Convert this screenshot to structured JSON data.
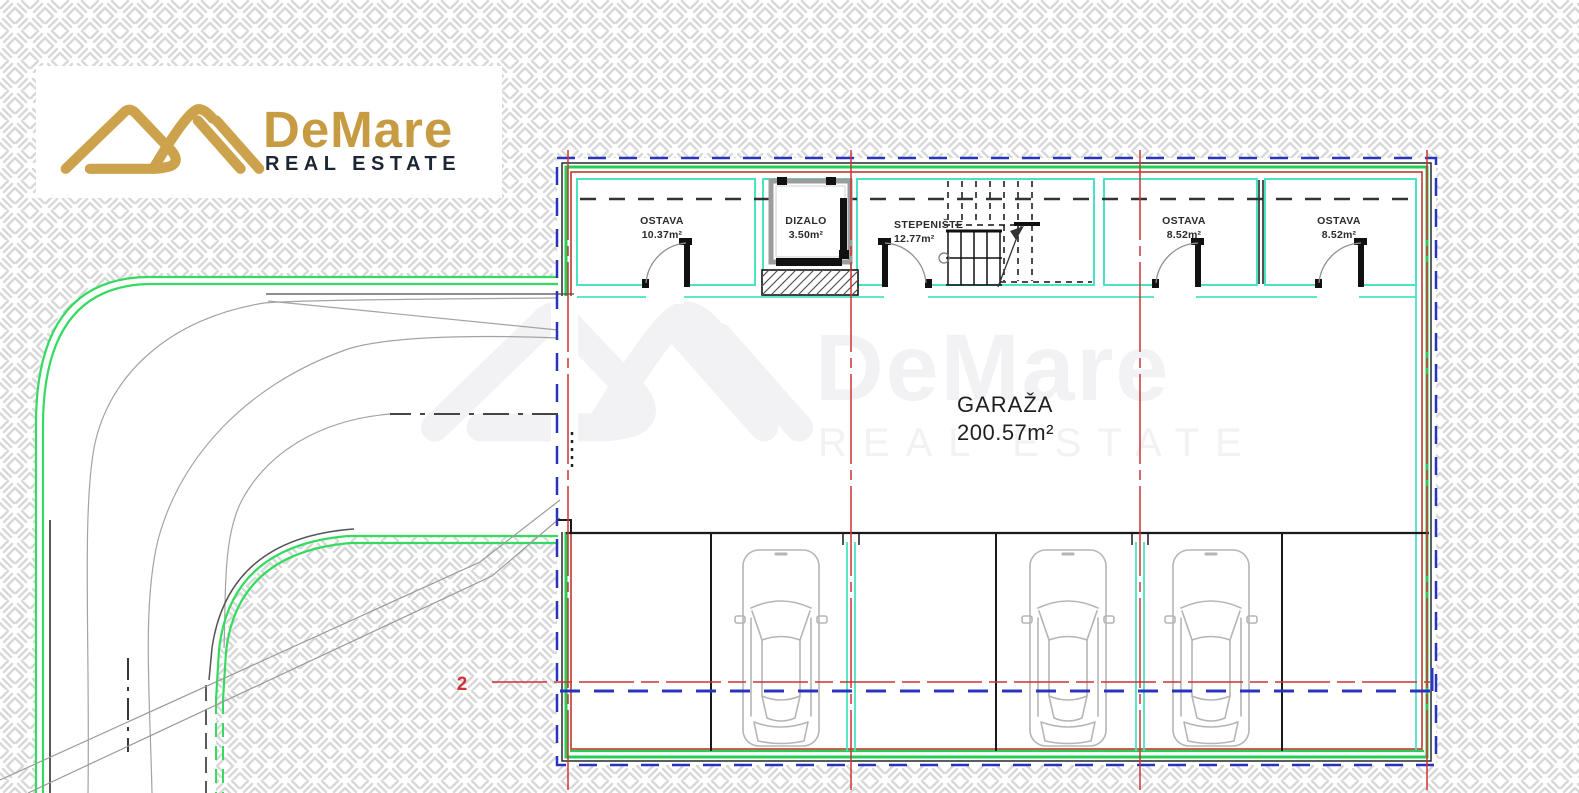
{
  "brand": {
    "name": "DeMare",
    "tagline": "REAL ESTATE"
  },
  "watermark": {
    "name": "DeMare",
    "tagline": "REAL ESTATE"
  },
  "plan": {
    "rooms": [
      {
        "id": "ostava-1",
        "name": "OSTAVA",
        "area": "10.37m²"
      },
      {
        "id": "dizalo",
        "name": "DIZALO",
        "area": "3.50m²"
      },
      {
        "id": "stepeniste",
        "name": "STEPENIŠTE",
        "area": "12.77m²"
      },
      {
        "id": "ostava-2",
        "name": "OSTAVA",
        "area": "8.52m²"
      },
      {
        "id": "ostava-3",
        "name": "OSTAVA",
        "area": "8.52m²"
      }
    ],
    "garage": {
      "name": "GARAŽA",
      "area": "200.57m²"
    },
    "section_marker": {
      "label": "2"
    },
    "parking": {
      "spaces": 6,
      "cars": 3
    }
  },
  "colors": {
    "wall_green": "#27cd55",
    "road_green": "#35db60",
    "inner_wall_cyan": "#49e3c3",
    "grid_red": "#cc3434",
    "projection_blue": "#2834bd",
    "line_black": "#1a1a1a",
    "hatch_gray": "#d8d8d8",
    "car_gray": "#b5b5b5",
    "logo_gold": "#c79b42",
    "logo_navy": "#1c2733"
  }
}
